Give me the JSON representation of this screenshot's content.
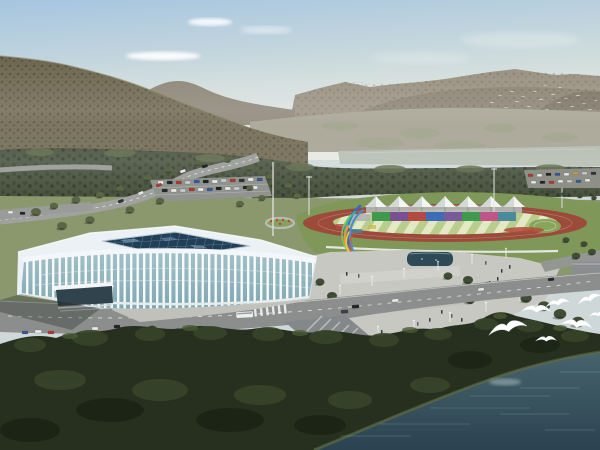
{
  "scene": {
    "description": "Aerial architectural rendering of a riverside sports complex: a white lattice-ribbed gymnasium with dark glass skylight roof, an athletics track with seven white canopy tents and rainbow stands, a colorful ribbon sculpture on a plaza, roads with cars and a bus, forested mountains, a pale river, dark foreground woods, a teal lake and flying white egrets",
    "palette": {
      "sky_top": "#a6c5e0",
      "sky_mid": "#cfdcdc",
      "sky_horizon": "#e7e8e2",
      "cloud": "#ffffff",
      "mountain_left": "#6f6850",
      "mountain_left_speckle": "#4a4435",
      "ridge_far": "#8d8678",
      "mountain_right": "#9a9181",
      "mountain_right_shade": "#887f6f",
      "valley": "#a5a292",
      "river": "#b5bdb2",
      "tree_band": "#4a5340",
      "tree_band_dark": "#39432d",
      "grass_mid": "#8b976d",
      "grass_apron": "#7f9758",
      "tree_olive": "#5c6647",
      "tree_dark": "#414c36",
      "tree_row": "#333d28",
      "road": "#8b8e8c",
      "road_light": "#9fa29e",
      "parking": "#90938e",
      "lane_marking": "#f2f2ee",
      "plaza": "#c7c8c2",
      "pond": "#2e4a57",
      "track_surface": "#9c4a3a",
      "field_stripe_a": "#b9cd8d",
      "field_stripe_b": "#e3e9c5",
      "fence": "#e9ebe7",
      "flowerbed": "#b04a3a",
      "tent": "#f3f5f2",
      "tent_shade": "#ccd2cf",
      "gym_roof": "#ebf1f4",
      "gym_skylight": "#223f58",
      "gym_grid": "#7e9cb4",
      "gym_glass_top": "#a3c0c8",
      "gym_glass_bottom": "#7fa8b2",
      "gym_rib": "#f6fafb",
      "gym_entrance": "#31434c",
      "foreground_trees": "#27301f",
      "foreground_trees_light": "#38452a",
      "water_top": "#47636d",
      "water_bottom": "#2b4350",
      "bird": "#ffffff",
      "pedestal": "#46494b"
    },
    "stands_colors": [
      "#3f9a4e",
      "#7c4f93",
      "#b34a44",
      "#3f6cb8",
      "#7a5a9a",
      "#3f9a4e",
      "#c0558a",
      "#4a8a9a"
    ],
    "sculpture_colors": [
      "#2f6cc4",
      "#4a8ad8",
      "#35b3a4",
      "#7cc860",
      "#e8992f",
      "#ecc93f",
      "#d4572f"
    ],
    "counts": {
      "tents": 7,
      "egrets": 7,
      "flock_birds": 20
    }
  }
}
